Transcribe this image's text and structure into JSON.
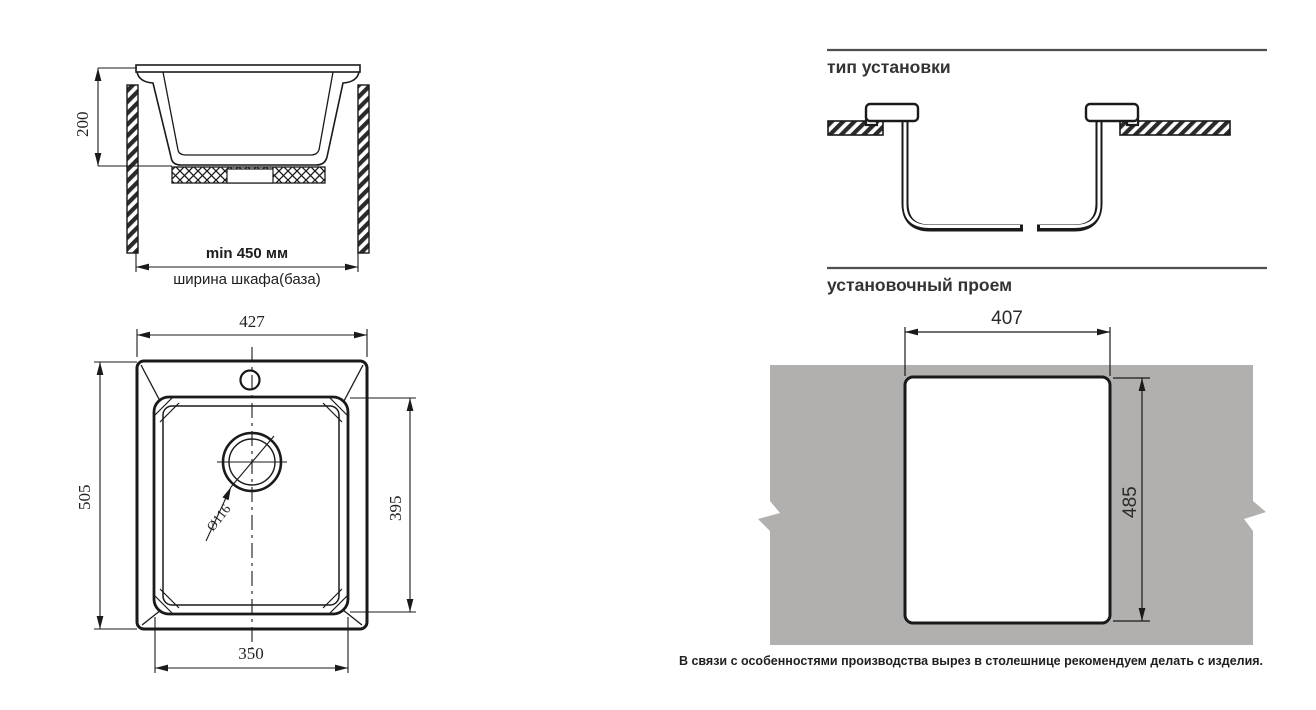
{
  "cross_section": {
    "dim_height": "200",
    "dim_min_width": "min 450 мм",
    "cabinet_label": "ширина шкафа(база)"
  },
  "top_view": {
    "dim_overall_width": "427",
    "dim_overall_depth": "505",
    "dim_bowl_depth": "395",
    "dim_bowl_width": "350",
    "dim_drain_diameter": "Ø116"
  },
  "install_type": {
    "title": "тип установки"
  },
  "cutout": {
    "title": "установочный проем",
    "dim_width": "407",
    "dim_height": "485"
  },
  "footnote": "В связи с особенностями производства вырез в столешнице рекомендуем делать с изделия.",
  "colors": {
    "line": "#1a1a1a",
    "countertop_gray": "#b1b0ae",
    "header_rule": "#4f4f4f"
  }
}
